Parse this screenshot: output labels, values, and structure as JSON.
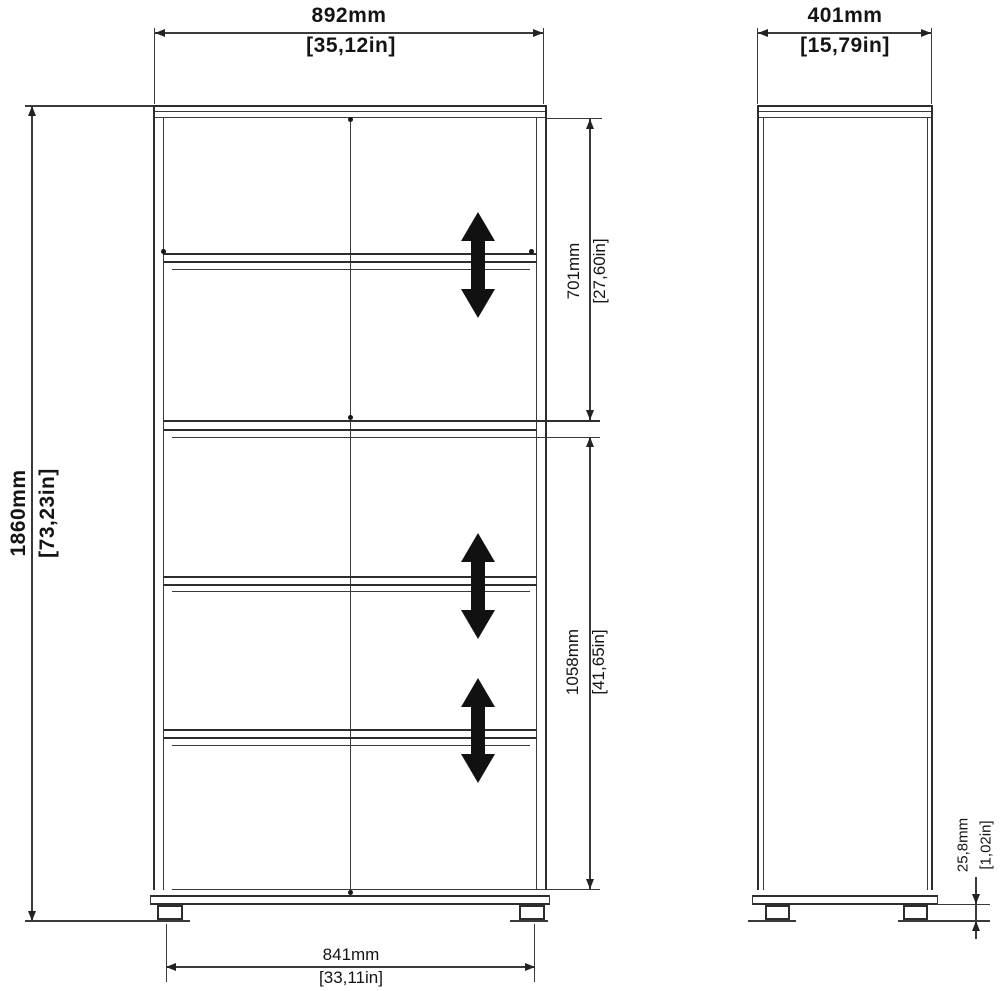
{
  "dimensions": {
    "front_width": {
      "mm": "892mm",
      "in": "[35,12in]"
    },
    "depth": {
      "mm": "401mm",
      "in": "[15,79in]"
    },
    "height": {
      "mm": "1860mm",
      "in": "[73,23in]"
    },
    "upper_section": {
      "mm": "701mm",
      "in": "[27,60in]"
    },
    "lower_section": {
      "mm": "1058mm",
      "in": "[41,65in]"
    },
    "foot_height": {
      "mm": "25,8mm",
      "in": "[1,02in]"
    },
    "base_width": {
      "mm": "841mm",
      "in": "[33,11in]"
    }
  },
  "colors": {
    "line": "#2d2d2d",
    "arrow": "#111111",
    "text": "#141414",
    "background": "#ffffff"
  }
}
